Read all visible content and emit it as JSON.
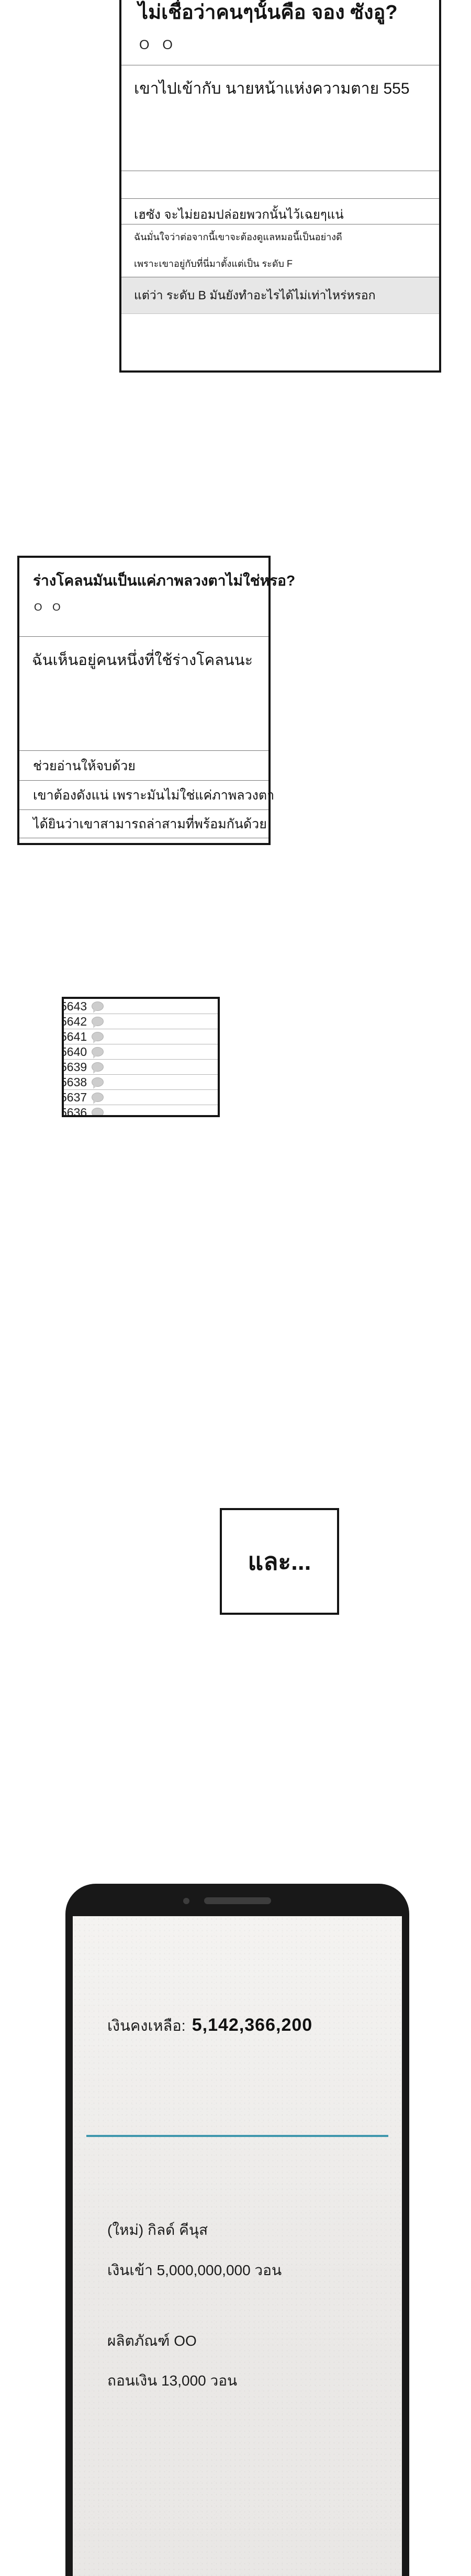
{
  "page": {
    "background": "#ffffff"
  },
  "colors": {
    "panel_border": "#141414",
    "divider": "#777777",
    "list_row_divider": "#b5b5b5",
    "gray_row_bg": "#e7e7e7",
    "bubble_icon": "#cdcdcd",
    "phone_frame": "#181818",
    "phone_screen": "#ebe9e7",
    "accent_teal": "#3f97ad"
  },
  "icons": {
    "comment_bubble": "comment-bubble-icon (gray oval speech bubble with tail)",
    "phone_speaker": "phone-speaker-slot (dark rounded bar)",
    "phone_camera": "phone-camera-dot (dark circle)"
  },
  "post1": {
    "title": "ไม่เชื่อว่าคนๆนั้นคือ จอง ซังอู?",
    "author": "O O",
    "comment1": "เขาไปเข้ากับ นายหน้าแห่งความตาย 555",
    "comment2": "เฮซัง จะไม่ยอมปล่อยพวกนั้นไว้เฉยๆแน่",
    "comment3_line1": "ฉันมั่นใจว่าต่อจากนี้เขาจะต้องดูแลหมอนี้เป็นอย่างดี",
    "comment3_line2": "เพราะเขาอยู่กับที่นี่มาตั้งแต่เป็น ระดับ F",
    "comment4": "แต่ว่า ระดับ B มันยังทำอะไรได้ไม่เท่าไหร่หรอก"
  },
  "post2": {
    "title": "ร่างโคลนมันเป็นแค่ภาพลวงตาไม่ใช่หรอ?",
    "author": "O O",
    "comment1": "ฉันเห็นอยู่คนหนึ่งที่ใช้ร่างโคลนนะ",
    "comment2": "ช่วยอ่านให้จบด้วย",
    "comment3": "เขาต้องดังแน่ เพราะมันไม่ใช่แค่ภาพลวงตา",
    "comment4": "ได้ยินว่าเขาสามารถล่าสามที่พร้อมกันด้วย"
  },
  "post_list": {
    "rows": [
      "5643",
      "5642",
      "5641",
      "5640",
      "5639",
      "5638",
      "5637",
      "5636"
    ]
  },
  "caption": {
    "text": "และ..."
  },
  "phone": {
    "balance_label": "เงินคงเหลือ:",
    "balance_value": "5,142,366,200",
    "notification": {
      "line1": "(ใหม่) กิลด์ คีนุส",
      "line2": "เงินเข้า 5,000,000,000 วอน",
      "line3": "ผลิตภัณฑ์ OO",
      "line4": "ถอนเงิน 13,000 วอน"
    }
  }
}
